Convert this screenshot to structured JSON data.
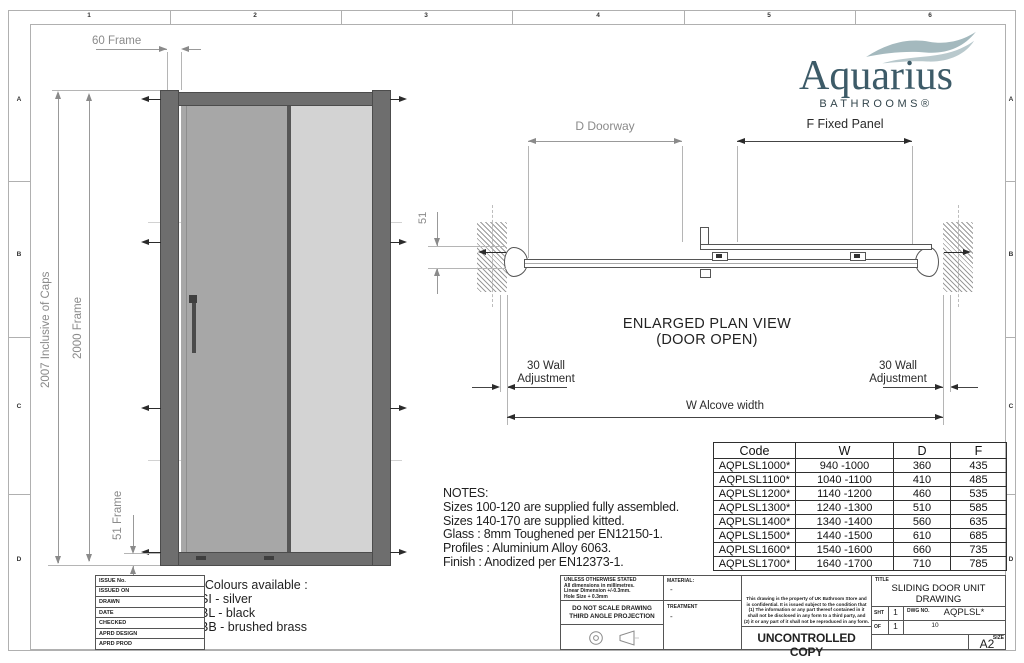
{
  "zones": {
    "cols": [
      "1",
      "2",
      "3",
      "4",
      "5",
      "6"
    ],
    "rows": [
      "A",
      "B",
      "C",
      "D"
    ]
  },
  "logo": {
    "name": "Aquarius",
    "subtitle": "BATHROOMS®",
    "text_color": "#3d5b68",
    "wave_color": "#a4b9be"
  },
  "elevation": {
    "dim_top": "60 Frame",
    "dim_outer": "2007 Inclusive of Caps",
    "dim_inner": "2000 Frame",
    "dim_bottom": "51 Frame"
  },
  "plan": {
    "dim_doorway": "D Doorway",
    "dim_fixed_panel": "F Fixed Panel",
    "dim_depth": "51",
    "caption_line1": "ENLARGED PLAN VIEW",
    "caption_line2": "(DOOR OPEN)",
    "wall_adjustment_line1": "30 Wall",
    "wall_adjustment_line2": "Adjustment",
    "dim_alcove": "W Alcove width"
  },
  "notes": {
    "title": "NOTES:",
    "lines": [
      "Sizes 100-120 are supplied fully assembled.",
      "Sizes 140-170 are supplied kitted.",
      "Glass : 8mm Toughened per EN12150-1.",
      "Profiles : Aluminium Alloy 6063.",
      "Finish : Anodized per EN12373-1."
    ]
  },
  "colours": {
    "title": "*Colours available :",
    "options": [
      "SI - silver",
      "BL - black",
      "BB - brushed brass"
    ]
  },
  "size_table": {
    "headers": [
      "Code",
      "W",
      "D",
      "F"
    ],
    "rows": [
      {
        "code": "AQPLSL1000*",
        "w": "940 -1000",
        "d": "360",
        "f": "435"
      },
      {
        "code": "AQPLSL1100*",
        "w": "1040 -1100",
        "d": "410",
        "f": "485"
      },
      {
        "code": "AQPLSL1200*",
        "w": "1140 -1200",
        "d": "460",
        "f": "535"
      },
      {
        "code": "AQPLSL1300*",
        "w": "1240 -1300",
        "d": "510",
        "f": "585"
      },
      {
        "code": "AQPLSL1400*",
        "w": "1340 -1400",
        "d": "560",
        "f": "635"
      },
      {
        "code": "AQPLSL1500*",
        "w": "1440 -1500",
        "d": "610",
        "f": "685"
      },
      {
        "code": "AQPLSL1600*",
        "w": "1540 -1600",
        "d": "660",
        "f": "735"
      },
      {
        "code": "AQPLSL1700*",
        "w": "1640 -1700",
        "d": "710",
        "f": "785"
      }
    ]
  },
  "title_block": {
    "left_labels": [
      "ISSUE No.",
      "ISSUED ON",
      "DRAWN",
      "DATE",
      "CHECKED",
      "APRD DESIGN",
      "APRD PROD"
    ],
    "tolerance_lines": [
      "UNLESS OTHERWISE STATED",
      "All dimensions in millimetres.",
      "Linear Dimension +/-0.3mm.",
      "Hole Size + 0.3mm"
    ],
    "material_label": "MATERIAL:",
    "material_value": "-",
    "scale_warning": "DO NOT SCALE DRAWING",
    "projection": "THIRD ANGLE PROJECTION",
    "treatment_label": "TREATMENT",
    "treatment_value": "-",
    "legal_lines": [
      "This drawing is the property of UK Bathroom Store and",
      "is confidential. It is issued subject to the condition that",
      "(1) The information or any part thereof contained in it",
      "shall not be disclosed in any form to a third party, and",
      "(2) it or any part of it shall not be reproduced in any form."
    ],
    "stamp": "UNCONTROLLED COPY",
    "title_label": "TITLE",
    "title_line1": "SLIDING DOOR UNIT",
    "title_line2": "DRAWING",
    "sht_label": "SHT",
    "sht_value": "1",
    "of_label": "OF",
    "of_value": "1",
    "dwg_label": "DWG NO.",
    "dwg_value": "AQPLSL*",
    "dwg_issue": "10",
    "size_label": "SIZE",
    "size_value": "A2"
  }
}
